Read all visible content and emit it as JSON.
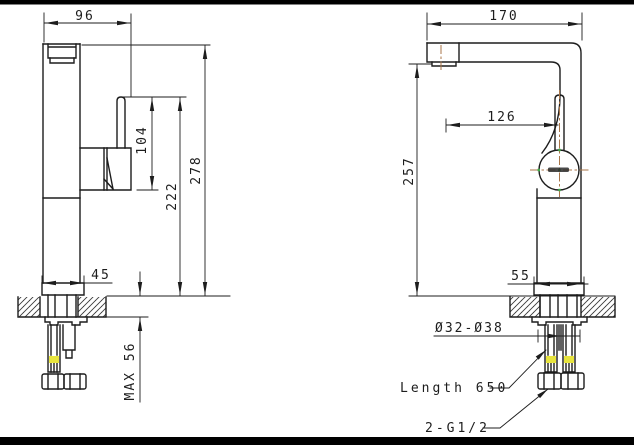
{
  "drawing": {
    "side_view": {
      "top_width": "96",
      "handle_height": "104",
      "spout_to_deck": "222",
      "overall_height": "278",
      "base_width": "45",
      "max_deck_thickness": "MAX 56"
    },
    "front_view": {
      "top_depth": "170",
      "spout_reach": "126",
      "outlet_height": "257",
      "base_width": "55"
    },
    "callouts": {
      "hole_diameter": "Ø32-Ø38",
      "hose_length": "Length 650",
      "thread_spec": "2-G1/2"
    },
    "colors": {
      "line": "#1d1d1d",
      "centerline": "#a8764a",
      "center_mark": "#3fae4a",
      "hose_highlight": "#e8e53e",
      "frame": "#000000",
      "paper": "#ffffff"
    }
  }
}
